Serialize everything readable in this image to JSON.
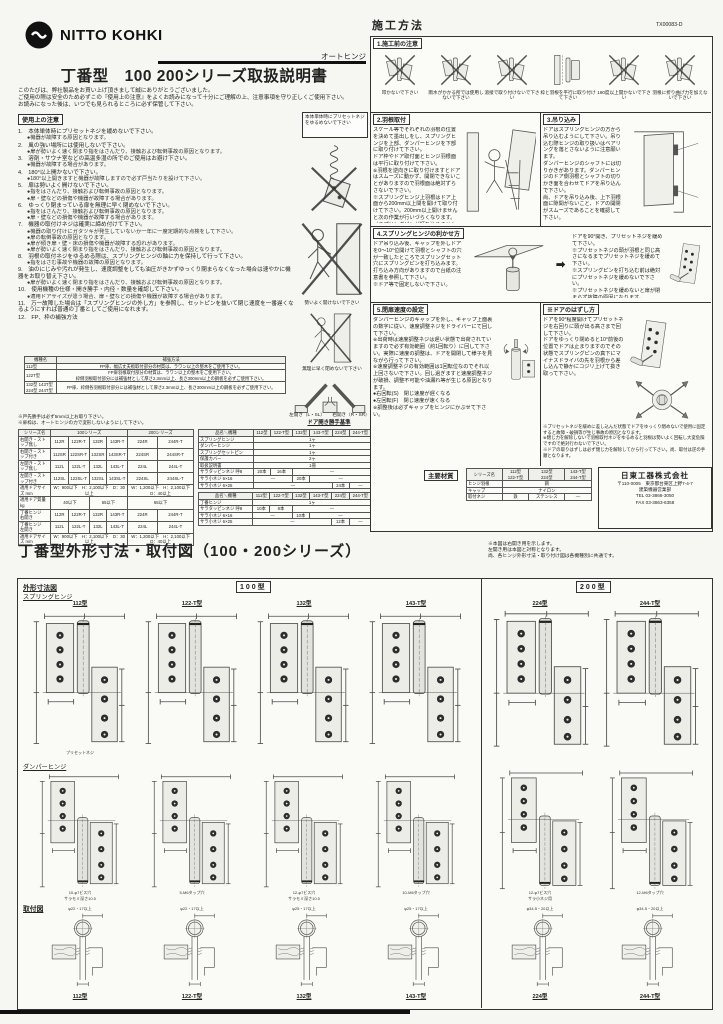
{
  "page": {
    "brand": "NITTO KOHKI",
    "product_type": "オートヒンジ",
    "title": "丁番型　100 200シリーズ取扱説明書",
    "doc_number": "TX00083-D",
    "intro": [
      "このたびは、弊社製品をお買い上げ頂きまして誠にありがとうございました。",
      "ご使用の際は安全のため必ずこの『使用上の注意』をよくお読みになって十分にご理解の上、注意事項を守り正しくご使用下さい。",
      "お読みになった後は、いつでも見られるところに必ず保管して下さい。"
    ]
  },
  "left": {
    "section_title": "使用上の注意",
    "side_note": "本体単体時にプリセットネジをゆるめないで下さい",
    "precautions": [
      {
        "n": "1",
        "t": "本体単体時にプリセットネジを緩めないで下さい。",
        "b": [
          "機器が故障する原因となります。"
        ]
      },
      {
        "n": "2",
        "t": "風の強い場所には使用しないで下さい。",
        "b": [
          "扉が勢いよく速く閉まり指をはさんだり、接触および転倒事故の原因となります。"
        ]
      },
      {
        "n": "3",
        "t": "溶剤・サウナ室などの高温多湿の所でのご使用はお避け下さい。",
        "b": [
          "機器が故障する場合があります。"
        ]
      },
      {
        "n": "4",
        "t": "180°以上開かないで下さい。",
        "b": [
          "180°以上開きますと機器が故障しますので必ず戸当たりを設けて下さい。"
        ]
      },
      {
        "n": "5",
        "t": "扉は勢いよく開けないで下さい。",
        "b": [
          "指をはさんだり、接触および転倒事故の原因となります。",
          "扉・壁などの損傷や機器が故障する場合があります。"
        ]
      },
      {
        "n": "6",
        "t": "ゆっくり閉まっている扉を無理に早く閉めないで下さい。",
        "b": [
          "指をはさんだり、接触および転倒事故の原因となります。",
          "扉・壁などの損傷や機器が故障する場合があります。"
        ]
      },
      {
        "n": "7",
        "t": "機器の取付けネジは確実に締め付けて下さい。",
        "b": [
          "機器の取り付けにガタツキが発生していないか一年に一度定期的な点検をして下さい。",
          "扉の転倒事故の原因となります。",
          "扉が傾き扉・壁・床の損傷や機器が故障する恐れがあります。",
          "扉が勢いよく速く閉まり指をはさんだり、接触および転倒事故の原因となります。"
        ]
      },
      {
        "n": "8",
        "t": "羽根の取付ネジをゆるめる際は、スプリングヒンジの軸に力を保持して行って下さい。",
        "b": [
          "指をはさむ事故や機器の故障の原因となります。"
        ]
      },
      {
        "n": "9",
        "t": "油のにじみや汚れが発生し、速度調整をしても油圧がきかずゆっくり閉まらなくなった場合は速やかに機器をお取り替え下さい。",
        "b": [
          "扉が勢いよく速く閉まり指をはさんだり、接触および転倒事故の原因となります。"
        ]
      },
      {
        "n": "10",
        "t": "使用機種の仕様・開き勝手・内径・数量を確認して下さい。",
        "b": [
          "適用ドアサイズが違う場合、扉・壁などの損傷や機器が故障する場合があります。"
        ]
      },
      {
        "n": "11",
        "t": "万一故障した場合は「スプリングヒンジの外し方」を参照し、セットピンを抜いて閉じ速度を一番遅くなるようにすれば普通の丁番としてご使用になれます。",
        "b": []
      },
      {
        "n": "12",
        "t": "FP、枠の補強方法",
        "b": []
      }
    ],
    "fig_captions": {
      "open": "勢いよく開けないで下さい",
      "close": "無理に早く閉めないで下さい",
      "left_open": "左開き（L・SL）",
      "right_open": "右開き（R・SR）",
      "doors_caption": "ドア開き勝手基準"
    },
    "reinforce_table": {
      "headers": [
        "機種名",
        "補強方法"
      ],
      "rows": [
        [
          "112型",
          "FP扉、幅広丈夫板取付部分の材質は、ラワン以上の堅木をご使用下さい。"
        ],
        [
          "122T型",
          "FP扉羽根取付部分の材質は、ラワン以上の堅木をご使用下さい。\n枠側羽根取付部分には補強材として厚さ2.3mm以上、長さ300mm以上の鋼板を必ずご使用下さい。"
        ],
        [
          "132型 143T型\n224型 244T型",
          "FP扉、枠側各羽根取付部分には補強材として厚さ2.3mm以上、長さ300mm以上の鋼板を必ずご使用下さい。"
        ]
      ]
    },
    "table_notes": [
      "※戸先勝手は必ず5mm以上お取り下さい。",
      "※扉枠は、オートヒンジの力で変形しないようにして下さい。"
    ],
    "spec_table": {
      "headers": [
        "シリーズ名",
        {
          "t": "100シリーズ",
          "cs": 4
        },
        {
          "t": "200シリーズ",
          "cs": 2
        }
      ],
      "rows": [
        [
          "右開き・ストップ無し",
          "112R",
          "122R-T",
          "132R",
          "143R-T",
          "224R",
          "244R-T"
        ],
        [
          "右開き・ストップ付き",
          "112SR",
          "122SR-T",
          "132SR",
          "143SR-T",
          "224SR",
          "244SR-T"
        ],
        [
          "左開き・ストップ無し",
          "112L",
          "122L-T",
          "132L",
          "143L-T",
          "224L",
          "244L-T"
        ],
        [
          "左開き・ストップ付き",
          "112SL",
          "122SL-T",
          "132SL",
          "143SL-T",
          "224SL",
          "244SL-T"
        ],
        [
          "適用ドアサイズ mm",
          {
            "t": "W：900以下　H：2,100以下　D：30以上",
            "cs": 4
          },
          {
            "t": "W：1,200以下　H：2,100以下　D：40以上",
            "cs": 2
          }
        ],
        [
          "適用ドア質量 kg",
          {
            "t": "40以下",
            "cs": 2
          },
          {
            "t": "65以下",
            "cs": 2
          },
          {
            "t": "65以下",
            "cs": 2
          }
        ],
        [
          "丁番ヒンジ　右開き",
          "112R",
          "122R-T",
          "132R",
          "143R-T",
          "224R",
          "244R-T"
        ],
        [
          "丁番ヒンジ　左開き",
          "112L",
          "122L-T",
          "132L",
          "143L-T",
          "224L",
          "244L-T"
        ],
        [
          "適用ドアサイズ mm",
          {
            "t": "W：900以下　H：2,100以下　D：30以上",
            "cs": 4
          },
          {
            "t": "W：1,200以下　H：2,100以下　D：40以上",
            "cs": 2
          }
        ]
      ]
    },
    "parts_table_a": {
      "headers": [
        "品名＼機種",
        "112型",
        "122-T型",
        "132型",
        "143-T型",
        "224型",
        "244-T型"
      ],
      "rows": [
        [
          "スプリングヒンジ",
          {
            "t": "1ヶ",
            "cs": 6
          }
        ],
        [
          "ダンパーヒンジ",
          {
            "t": "1ヶ",
            "cs": 6
          }
        ],
        [
          "スプリングセットピン",
          {
            "t": "1ヶ",
            "cs": 6
          }
        ],
        [
          "保護カバー",
          {
            "t": "2ヶ",
            "cs": 6
          }
        ],
        [
          "取扱説明書",
          {
            "t": "1冊",
            "cs": 6
          }
        ],
        [
          "サラタッピンネジ 呼8",
          "20本",
          "16本",
          {
            "t": "―",
            "cs": 4
          }
        ],
        [
          "サラ小ネジ 6×16",
          {
            "t": "―",
            "cs": 2
          },
          "20本",
          {
            "t": "―",
            "cs": 3
          }
        ],
        [
          "サラ小ネジ 6×25",
          {
            "t": "―",
            "cs": 4
          },
          "24本",
          "―"
        ]
      ]
    },
    "parts_table_b": {
      "headers": [
        "品名＼機種",
        "112型",
        "122-T型",
        "132型",
        "143-T型",
        "224型",
        "244-T型"
      ],
      "rows": [
        [
          "丁番ヒンジ",
          {
            "t": "1ヶ",
            "cs": 6
          }
        ],
        [
          "サラタッピンネジ 呼8",
          "10本",
          "8本",
          {
            "t": "―",
            "cs": 4
          }
        ],
        [
          "サラ小ネジ 6×16",
          {
            "t": "―",
            "cs": 2
          },
          "10本",
          {
            "t": "―",
            "cs": 3
          }
        ],
        [
          "サラ小ネジ 6×25",
          {
            "t": "―",
            "cs": 4
          },
          "12本",
          "―"
        ]
      ]
    }
  },
  "right": {
    "section_title": "施工方法",
    "sec1": {
      "title": "1.施工前の注意",
      "captions": [
        "叩かないで下さい",
        "雨水がかかる所では使用しないで下さい",
        "溶接で取り付けないで下さい",
        "枠と羽根を平行に取り付けて下さい",
        "180度以上開かないで下さい",
        "羽根に折り曲げ力を加えないで下さい"
      ]
    },
    "sec2": {
      "title": "2.羽根取付",
      "body": "スケール等でそれぞれの羽根の位置を決めて墨出しをし、スプリングヒンジを上部、ダンパーヒンジを下部に取り付けて下さい。\nドア枠やドア取付面とヒンジ羽根面は平行に取り付けて下さい。\n※羽根を逆向きに取り付けますとドアはスムーズに動かず、開閉できないことがありますので羽根面は絶対ずらさないで下さい。\n※スプリングヒンジ上羽根はドア上面から200mm以上間を開けて取り付けて下さい。200mm以上開けませんと次の作業が行いづらくなります。（スプリングピンが打ち込めませんのでご注意下さい）"
    },
    "sec3": {
      "title": "3.吊り込み",
      "body": "ドアはスプリングヒンジの方から吊り込むようにして下さい。吊り込む際ヒンジの取り扱いはベアリングを落とさないように注意願います。\nダンパーヒンジのシャフトには切りかきがあります。ダンパーヒンジのドア側羽根とシャフトの切りかき面を合わせてドアを吊り込んで下さい。\n尚、ドアを吊り込み後、上下羽根面に隙間がないこと、ドアの開閉がスムーズであることを確認して下さい。"
    },
    "sec4": {
      "title": "4.スプリングヒンジの利かせ方",
      "body_left": "ドア吊り込み後、キャップを外しドアを0～10°位開けて羽根とシャフトの穴が一致したところでスプリングセット穴にスプリングピンを打ち込みます。\n打ち込み方向がありますので台紙の注意書を参照して下さい。\n※ドア等で固定しないで下さい。",
      "body_right": "ドアを90°開き、プリセットネジを緩めて下さい。\n※プリセットネジの頭が羽根と同じ高さになるまでプリセットネジを緩めて下さい。\n※スプリングピンを打ち込む前は絶対にプリセットネジを緩めないで下さい。\n※プリセットネジを緩めないと扉が閉まらず故障の原因になります。\n確実に閉まることを確認しキャップをヒンジにかぶせて下さい。",
      "labels": {
        "waku": "枠",
        "door": "ドア",
        "pin": "スプリングピン",
        "ha": "上羽根",
        "deg": "約0～10°"
      }
    },
    "sec5": {
      "title": "5.閉扉速度の設定",
      "body": "ダンパーヒンジのキャップを外し、キャップ上面裏の数字に従い、速度調整ネジをドライバーにて回して下さい。\n※出荷時は速度調整ネジは遅い状態で出荷されていますので必ず有効範囲（約1回転り）に回して下さい。実際に速度の調整は、ドアを開閉して様子を見ながら行って下さい。\n※速度調整ネジの有効範囲は1回転位なのでそれ以上回さないで下さい。回し過ぎますと速度調整ネジが破損、調整不可能や油漏れ等が生じる原因となります。\n●右回転(S)　閉じ速度が遅くなる\n●左回転(F)　閉じ速度が速くなる\n※調整後は必ずキャップをヒンジにかぶせて下さい。"
    },
    "sec6": {
      "title": "※ドアのはずし方",
      "body": "ドアを90°程度開けてプリセットネジを右回りに頭が出る高さまで回して下さい。\nドアをゆっくり閉めると10°前後の位置でドアは止まりますのでその状態でスプリングピンの真下にマイナスドライバの先を羽根から差し込んで静かにコジリ上げて抜き取って下さい。",
      "notes": "※プリセットネジを緩めに差し込んだ状態でドアをゆっくり閉めないで使用に固定すると故障・破損等が生じ事故の原因となります。\n※閉じ力を解除しないで羽根取付ネジをゆるめると羽根は勢いよく回転し大変危険ですので絶対行わないで下さい。\n※ドアの取りはずしは必ず閉じ力を解除してから行って下さい。尚、取付は逆の手順となります。"
    },
    "materials": {
      "title": "主要材質",
      "table": {
        "headers": [
          "シリーズ名",
          "112型\n122-T型",
          "132型\n224型",
          "143-T型\n244-T型"
        ],
        "rows": [
          [
            "ヒンジ羽根",
            {
              "t": "鋼",
              "cs": 3
            }
          ],
          [
            "キャップ",
            {
              "t": "ナイロン",
              "cs": 3
            }
          ],
          [
            "取付ネジ",
            "鉄",
            "ステンレス",
            "―"
          ]
        ]
      }
    },
    "company": {
      "name": "日東工器株式会社",
      "address": "〒110-0005　東京都台東区上野7-4-7",
      "dept": "建築機器営業部",
      "tel": "TEL 03-3866-3050",
      "fax": "FAX 03-3863-6358"
    }
  },
  "bottom": {
    "title": "丁番型外形寸法・取付図（100・200シリーズ）",
    "note": "※本図は右開き用を示します。\n左開き用は本図と対称となります。\n尚、各ヒンジ外形寸法・取り付け図は各機種別に共通です。",
    "dim_label": "外形寸法図",
    "spring_label": "スプリングヒンジ",
    "damper_label": "ダンパーヒンジ",
    "mount_label": "取付図",
    "group_100": "100型",
    "group_200": "200型",
    "models": [
      "112型",
      "122-T型",
      "132型",
      "143-T型",
      "224型",
      "244-T型"
    ],
    "hole_notes": [
      "10-φ7ビス穴\nサラモミ深さ10.5",
      "5-M6タップ穴",
      "12-φ7ビス穴\nサラモミ深さ10.5",
      "10-M6タップ穴",
      "12-φ7ビス穴\nサラ小ネジ用",
      "12-M6タップ穴"
    ],
    "mount_dims": [
      "φ22・17以上",
      "φ22・17以上",
      "φ25・17以上",
      "φ25・17以上",
      "φ34.5・20以上",
      "φ34.5・20以上"
    ],
    "preset_label": "プリセットネジ"
  }
}
